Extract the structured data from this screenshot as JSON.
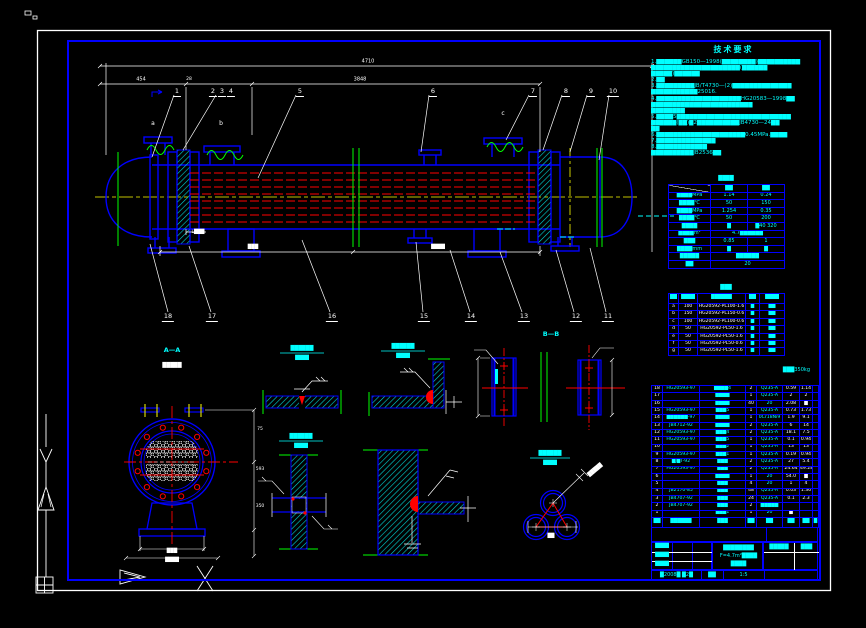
{
  "palette": {
    "line_blue": "#0000ff",
    "accent_cyan": "#00ffff",
    "tube_red": "#ff0000",
    "section_green": "#00ff00",
    "center_yellow": "#ffff00",
    "dim_white": "#ffffff"
  },
  "dims": {
    "overall": "4710",
    "seg1": "454",
    "seg2": "28",
    "seg3": "3848"
  },
  "labels": {
    "a": "a",
    "b": "b",
    "c": "c",
    "l": "L███",
    "dimblock1": "███",
    "dimblock2": "████"
  },
  "balloons": {
    "top": [
      {
        "n": "1",
        "x": 177,
        "y": 88
      },
      {
        "n": "2",
        "x": 213,
        "y": 88
      },
      {
        "n": "3",
        "x": 222,
        "y": 88
      },
      {
        "n": "4",
        "x": 231,
        "y": 88
      },
      {
        "n": "5",
        "x": 300,
        "y": 88
      },
      {
        "n": "6",
        "x": 433,
        "y": 88
      },
      {
        "n": "7",
        "x": 533,
        "y": 88
      },
      {
        "n": "8",
        "x": 566,
        "y": 88
      },
      {
        "n": "9",
        "x": 591,
        "y": 88
      },
      {
        "n": "10",
        "x": 613,
        "y": 88
      }
    ],
    "bottom": [
      {
        "n": "18",
        "x": 168,
        "y": 313
      },
      {
        "n": "17",
        "x": 212,
        "y": 313
      },
      {
        "n": "16",
        "x": 332,
        "y": 313
      },
      {
        "n": "15",
        "x": 424,
        "y": 313
      },
      {
        "n": "14",
        "x": 471,
        "y": 313
      },
      {
        "n": "13",
        "x": 524,
        "y": 313
      },
      {
        "n": "12",
        "x": 576,
        "y": 313
      },
      {
        "n": "11",
        "x": 608,
        "y": 313
      }
    ]
  },
  "aa": {
    "title": "A—A",
    "sub": "█████",
    "d1": "75",
    "d2": "593",
    "d3": "350",
    "b1": "███",
    "b2": "████"
  },
  "bb": {
    "title": "B—B"
  },
  "details": {
    "w1": {
      "t1": "██████",
      "t2": "████"
    },
    "w2": {
      "t1": "██████",
      "t2": "████"
    },
    "w3": {
      "t1": "██████",
      "t2": "████"
    },
    "tube": {
      "t1": "██████",
      "t2": "████",
      "leader": "█████",
      "dim": "██"
    }
  },
  "tech": {
    "title": "技术要求",
    "lines": [
      "1.██████GB150—1998(████████)██████████",
      "█████████████████████(██████",
      "█████)██████",
      "2.██",
      "3.█████████JB/T4730—(2)██████████████",
      "███████████25016.",
      "4.████████████████████HG20583—1998██",
      "████████████████████████",
      "████████",
      "5.████5███████████████████████████",
      "██████(██)█2██████████JB4730—24██",
      "██",
      "6.█████████████████████0.45MPa.████",
      "7.██████████████",
      "8.████████████",
      "██████████JB2536██"
    ]
  },
  "param": {
    "title": "████",
    "rows": [
      {
        "c0": "",
        "c1": "██",
        "c2": "██"
      },
      {
        "c0": "████MPa",
        "c1": "1.14",
        "c2": "0.24"
      },
      {
        "c0": "████℃",
        "c1": "50",
        "c2": "150"
      },
      {
        "c0": "████MPa",
        "c1": "1.254",
        "c2": "0.35"
      },
      {
        "c0": "████℃",
        "c1": "50",
        "c2": "200"
      },
      {
        "c0": "████",
        "c1": "█",
        "c2": "█40 320"
      },
      {
        "c0": "████m²",
        "span": "4.7██████"
      },
      {
        "c0": "███",
        "c1": "0.85",
        "c2": "1"
      },
      {
        "c0": "████mm",
        "c1": "█",
        "c2": "█"
      },
      {
        "c0": "█████",
        "span": "██████"
      },
      {
        "c0": "██",
        "span": "20"
      }
    ]
  },
  "nozzle": {
    "title": "███",
    "header": [
      "██",
      "████",
      "██████",
      "██",
      "████"
    ],
    "rows": [
      [
        "a",
        "100",
        "HG20592-PL100-1.6",
        "█",
        "██"
      ],
      [
        "b",
        "150",
        "HG20592-PL150-0.6",
        "█",
        "██"
      ],
      [
        "c",
        "100",
        "HG20592-PL100-0.6",
        "█",
        "██"
      ],
      [
        "d",
        "50",
        "HG20592-PL50-1.6",
        "█",
        "██"
      ],
      [
        "e",
        "50",
        "HG20592-PL50-1.6",
        "█",
        "██"
      ],
      [
        "f",
        "50",
        "HG20592-PL50-0.6",
        "█",
        "██"
      ],
      [
        "g",
        "50",
        "HG20592-PL50-1.6",
        "█",
        "██"
      ]
    ],
    "note": "███350kg"
  },
  "bom": {
    "rows": [
      [
        "18",
        "HG20593-97",
        "████4",
        "2",
        "Q235-A",
        "0.59",
        "1.14",
        ""
      ],
      [
        "17",
        "",
        "████",
        "1",
        "Q235-A",
        "2",
        "2",
        ""
      ],
      [
        "16",
        "",
        "████",
        "40",
        "20",
        "2.08",
        "█",
        ""
      ],
      [
        "15",
        "HG20593-97",
        "███5",
        "1",
        "Q235-A",
        "0.73",
        "1.73",
        ""
      ],
      [
        "14",
        "██████-97",
        "████",
        "1",
        "0Cr18Ni9",
        "1.9",
        "9.1",
        ""
      ],
      [
        "13",
        "JB4712-92",
        "████",
        "2",
        "Q235-A",
        "6",
        "14",
        ""
      ],
      [
        "12",
        "HG20593-97",
        "███4",
        "2",
        "Q235-A",
        "18.1",
        "7.5",
        ""
      ],
      [
        "11",
        "HG20593-97",
        "███5",
        "1",
        "Q235-A",
        "0.1",
        "0.94",
        ""
      ],
      [
        "10",
        "",
        "███2",
        "1",
        "Q235-A",
        "13",
        "13",
        ""
      ],
      [
        "9",
        "HG20593-97",
        "███1",
        "1",
        "Q235-A",
        "0.19",
        "0.94",
        ""
      ],
      [
        "8",
        "█J█T-92",
        "███",
        "2",
        "Q235-A",
        "27",
        "5.4",
        ""
      ],
      [
        "7",
        "HG20593-97",
        "███",
        "2",
        "Q235-A",
        "24.64",
        "49.28",
        ""
      ],
      [
        "6",
        "",
        "████",
        "1",
        "20",
        "54.0",
        "█",
        ""
      ],
      [
        "5",
        "",
        "███",
        "4",
        "20",
        "1",
        "4",
        ""
      ],
      [
        "4",
        "JB2170-85",
        "███",
        "48",
        "Q235-A",
        "0.03",
        "1.36",
        ""
      ],
      [
        "3",
        "JB4707-92",
        "███",
        "24",
        "Q235-A",
        "0.1",
        "2.3",
        ""
      ],
      [
        "2",
        "JB4707-92",
        "███",
        "2",
        "█████",
        "",
        "",
        ""
      ],
      [
        "1",
        "",
        "███1",
        "1",
        "20",
        "█",
        "",
        ""
      ]
    ],
    "header": [
      "██",
      "██████",
      "███",
      "██",
      "██",
      "██",
      "██",
      "█"
    ]
  },
  "title_block": {
    "mini": [
      "████",
      "████",
      "████"
    ],
    "center": [
      "████████",
      "F=4.7m²████",
      "████"
    ],
    "right_cells": [
      "█████",
      "███"
    ],
    "bottom": [
      "█2008█ █2█",
      "██",
      "1:5",
      ""
    ]
  }
}
